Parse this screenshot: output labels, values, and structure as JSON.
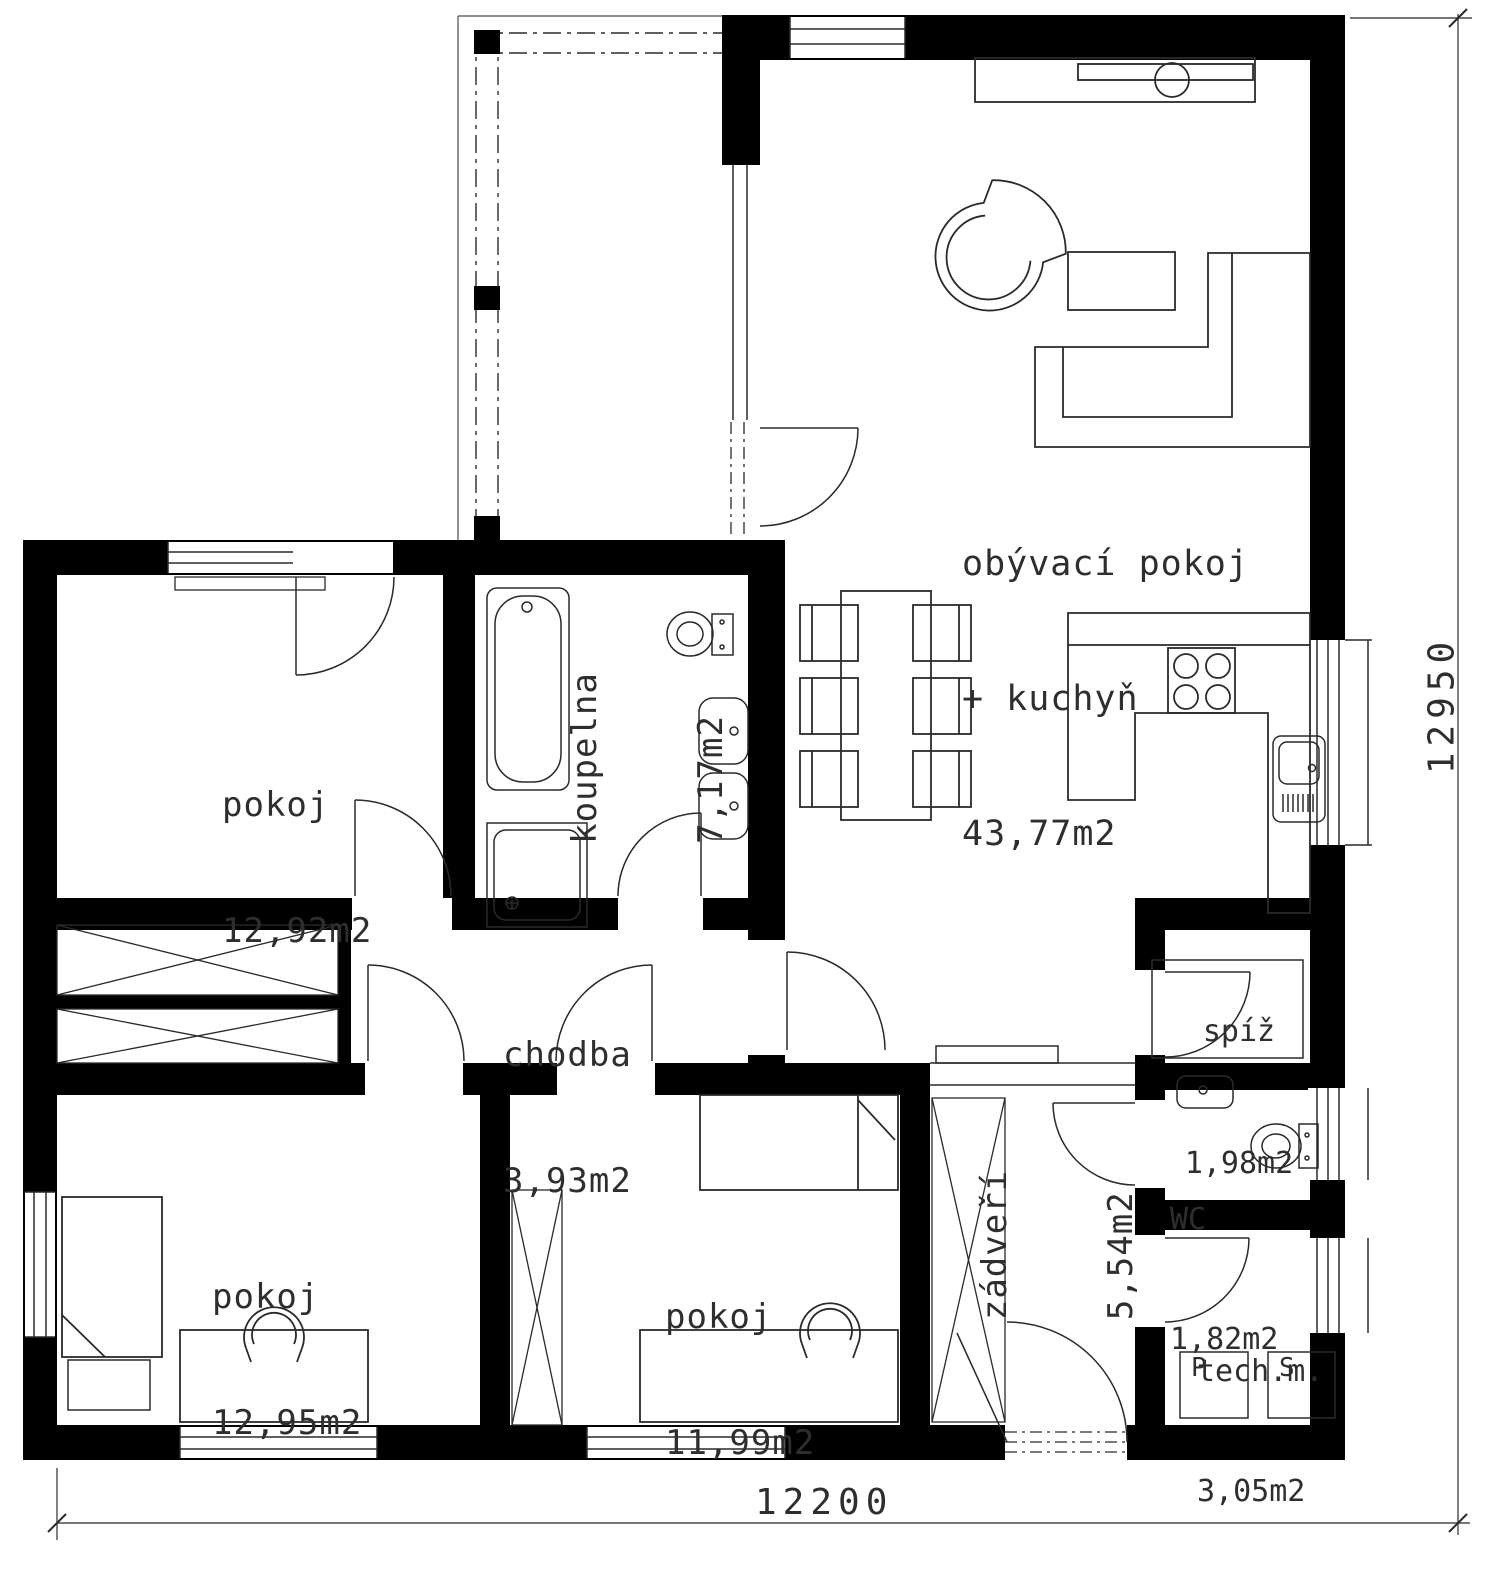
{
  "plan": {
    "rooms": {
      "living": {
        "name_line1": "obývací pokoj",
        "name_line2": "+ kuchyň",
        "area": "43,77m2"
      },
      "room1": {
        "name": "pokoj",
        "area": "12,92m2"
      },
      "bathroom": {
        "name": "koupelna",
        "area": "7,17m2"
      },
      "hallway": {
        "name": "chodba",
        "area": "3,93m2"
      },
      "pantry": {
        "name": "spíž",
        "area": "1,98m2"
      },
      "wc": {
        "name": "WC",
        "area": "1,82m2"
      },
      "tech_room": {
        "name": "tech.m.",
        "area": "3,05m2"
      },
      "vestibule": {
        "name": "zádveří",
        "area": "5,54m2"
      },
      "room2": {
        "name": "pokoj",
        "area": "12,95m2"
      },
      "room3": {
        "name": "pokoj",
        "area": "11,99m2"
      }
    },
    "appliances": {
      "washer": "P",
      "dryer": "S"
    },
    "dimensions": {
      "total_width_mm": "12200",
      "total_height_mm": "12950"
    },
    "colors": {
      "wall": "#000000",
      "line": "#2a2a2a",
      "background": "#ffffff"
    }
  }
}
